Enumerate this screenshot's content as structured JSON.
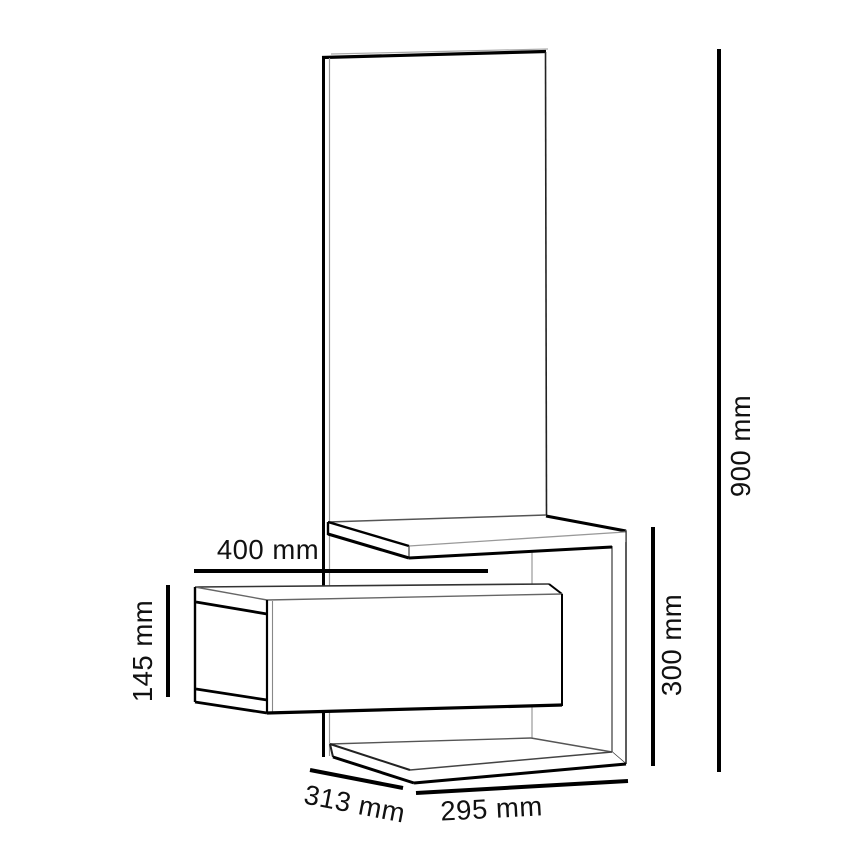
{
  "figure": {
    "type": "furniture-technical-drawing",
    "background_color": "#ffffff",
    "line_color": "#000000"
  },
  "dimensions": {
    "shelf_width": "400 mm",
    "drawer_front_height": "145 mm",
    "total_height": "900 mm",
    "side_frame_height": "300 mm",
    "depth": "313 mm",
    "base_width": "295 mm"
  }
}
